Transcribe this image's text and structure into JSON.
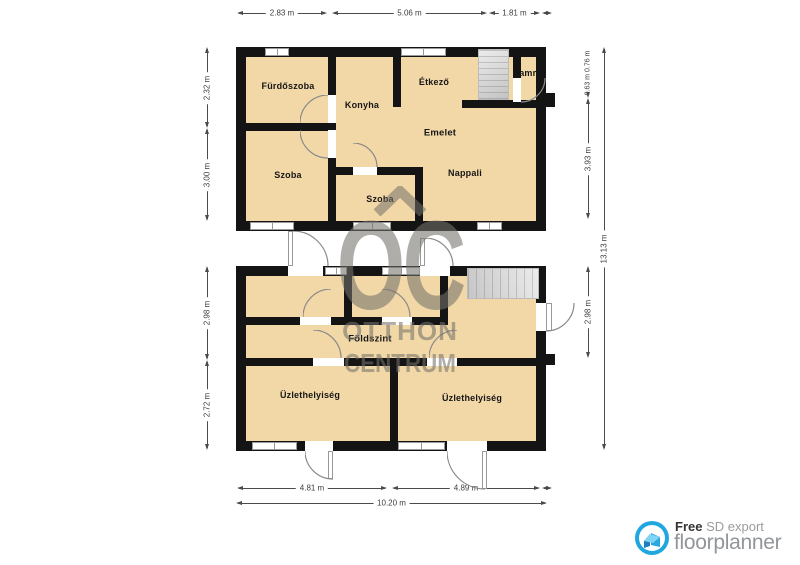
{
  "upper": {
    "title": "Emelet",
    "rooms": {
      "bathroom": "Fürdőszoba",
      "kitchen": "Konyha",
      "dining": "Étkező",
      "pantry": "Kamra",
      "living": "Nappali",
      "room_left": "Szoba",
      "room_mid": "Szoba"
    }
  },
  "ground": {
    "title": "Földszint",
    "rooms": {
      "shop_left": "Üzlethelyiség",
      "shop_right": "Üzlethelyiség"
    }
  },
  "dims": {
    "top": [
      "2.83 m",
      "5.06 m",
      "1.81 m"
    ],
    "bottom": [
      "4.81 m",
      "4.89 m"
    ],
    "bottom_total": "10.20 m",
    "left_upper": [
      "2.32 m",
      "3.00 m"
    ],
    "left_ground": [
      "2.98 m",
      "2.72 m"
    ],
    "right_small": [
      "0.63 m",
      "0.76 m"
    ],
    "right_upper": "3.93 m",
    "right_ground": "2.98 m",
    "right_total": "13.13 m"
  },
  "watermark": {
    "monogram": "OC",
    "line1": "OTTHON",
    "line2": "CENTRUM"
  },
  "logo": {
    "free": "Free",
    "export": " SD export",
    "brand": "floorplanner"
  },
  "colors": {
    "floor": "#f2d8a7",
    "wall": "#141414",
    "logo_blue": "#21a7e0",
    "watermark_gray": "#74716a"
  }
}
